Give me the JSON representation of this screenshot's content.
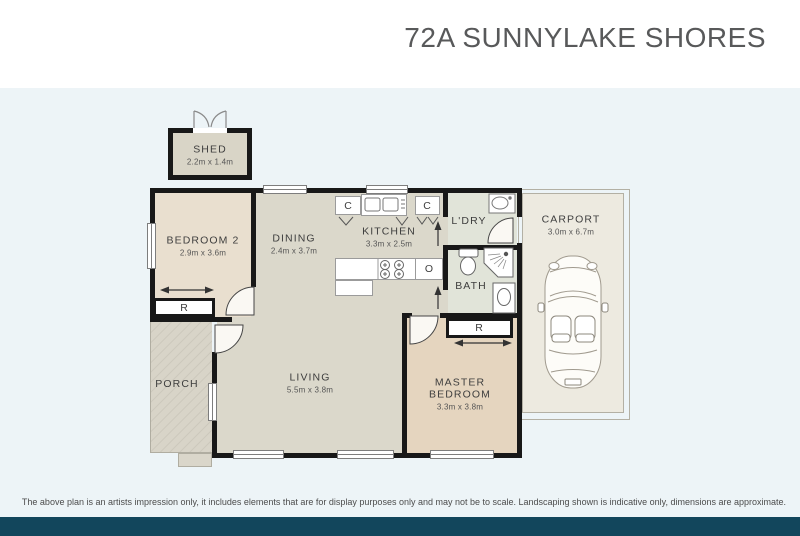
{
  "header": {
    "title": "72A SUNNYLAKE SHORES"
  },
  "footer": {
    "disclaimer": "The above plan is an artists impression only, it includes elements that are for display purposes only and may not be to scale. Landscaping shown is indicative only, dimensions are approximate."
  },
  "colors": {
    "page_background": "#ffffff",
    "plan_background": "#edf4f7",
    "bottom_bar": "#12465c",
    "walls": "#181818",
    "title_text": "#58595a"
  },
  "rooms": {
    "shed": {
      "name": "SHED",
      "dims": "2.2m x 1.4m"
    },
    "bedroom2": {
      "name": "BEDROOM 2",
      "dims": "2.9m x 3.6m"
    },
    "dining": {
      "name": "DINING",
      "dims": "2.4m x 3.7m"
    },
    "kitchen": {
      "name": "KITCHEN",
      "dims": "3.3m x 2.5m"
    },
    "laundry": {
      "name": "L'DRY"
    },
    "bath": {
      "name": "BATH"
    },
    "carport": {
      "name": "CARPORT",
      "dims": "3.0m x 6.7m"
    },
    "living": {
      "name": "LIVING",
      "dims": "5.5m x 3.8m"
    },
    "master": {
      "name": "MASTER BEDROOM",
      "dims": "3.3m x 3.8m"
    },
    "porch": {
      "name": "PORCH"
    }
  },
  "fixtures": {
    "robe_label": "R",
    "cupboard_label": "C",
    "oven_label": "O"
  }
}
